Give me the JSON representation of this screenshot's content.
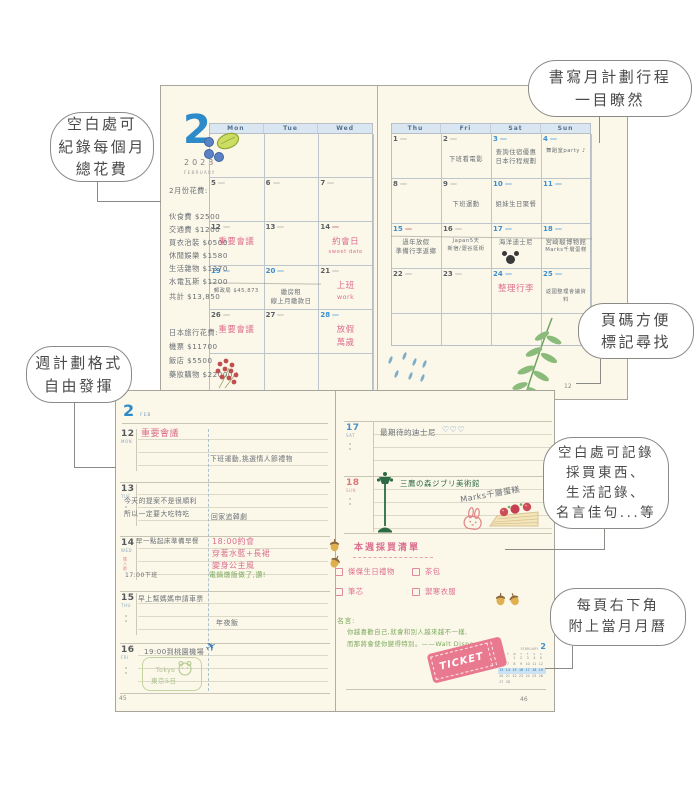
{
  "callouts": [
    {
      "id": "expense",
      "lines": [
        "空白處可",
        "紀錄每個月",
        "總花費"
      ]
    },
    {
      "id": "monthly-plan",
      "lines": [
        "書寫月計劃行程",
        "一目瞭然"
      ]
    },
    {
      "id": "page-number",
      "lines": [
        "頁碼方便",
        "標記尋找"
      ]
    },
    {
      "id": "weekly-format",
      "lines": [
        "週計劃格式",
        "自由發揮"
      ]
    },
    {
      "id": "blank-space",
      "lines": [
        "空白處可記錄",
        "採買東西、",
        "生活記錄、",
        "名言佳句...等"
      ]
    },
    {
      "id": "mini-calendar",
      "lines": [
        "每頁右下角",
        "附上當月月曆"
      ]
    }
  ],
  "monthly": {
    "month_number": "2",
    "year": "2023",
    "month_label": "FEBRUARY",
    "page_number": "12",
    "left_headers": [
      "Mon",
      "Tue",
      "Wed"
    ],
    "right_headers": [
      "Thu",
      "Fri",
      "Sat",
      "Sun"
    ],
    "expense_title": "2月份花費:",
    "expenses": [
      "伙食費 $2500",
      "交通費 $1200",
      "買衣治裝 $0500",
      "休閒娛樂 $1580",
      "生活雜物 $1370",
      "水電瓦斯 $1200"
    ],
    "expense_total": "共計 $13,850",
    "trip_title": "日本旅行花費:",
    "trip_expenses": [
      "機票 $11700",
      "飯店 $5500",
      "藥妝購物 $22000"
    ],
    "left_weeks": [
      [
        {
          "d": ""
        },
        {
          "d": ""
        },
        {
          "d": ""
        }
      ],
      [
        {
          "d": "5"
        },
        {
          "d": "6"
        },
        {
          "d": "7"
        }
      ],
      [
        {
          "d": "12",
          "notes": [
            {
              "t": "重要會議",
              "c": "pink",
              "big": true
            }
          ]
        },
        {
          "d": "13"
        },
        {
          "d": "14",
          "hl": "red",
          "notes": [
            {
              "t": "約會日",
              "c": "pink",
              "big": true
            },
            {
              "t": "sweet date",
              "c": "pink"
            }
          ]
        }
      ],
      [
        {
          "d": "19",
          "blue": true,
          "hl": "blue",
          "notes": [
            {
              "t": "郵政局 $45,873",
              "c": "ink"
            }
          ]
        },
        {
          "d": "20",
          "blue": true,
          "hl": "blue",
          "notes": [
            {
              "t": "繳房租",
              "c": "ink"
            },
            {
              "t": "線上月繳款日",
              "c": "ink"
            }
          ]
        },
        {
          "d": "21",
          "notes": [
            {
              "t": "上班",
              "c": "pink",
              "big": true
            },
            {
              "t": "work",
              "c": "pink"
            }
          ]
        }
      ],
      [
        {
          "d": "26",
          "notes": [
            {
              "t": "重要會議",
              "c": "pink",
              "big": true
            }
          ]
        },
        {
          "d": "27"
        },
        {
          "d": "28",
          "blue": true,
          "hl": "blue",
          "notes": [
            {
              "t": "放假",
              "c": "pink",
              "big": true
            },
            {
              "t": "萬歲",
              "c": "pink",
              "big": true
            }
          ]
        }
      ],
      [
        {
          "d": ""
        },
        {
          "d": ""
        },
        {
          "d": ""
        }
      ]
    ],
    "right_weeks": [
      [
        {
          "d": "1"
        },
        {
          "d": "2",
          "notes": [
            {
              "t": "下班看電影",
              "c": "ink"
            }
          ]
        },
        {
          "d": "3",
          "blue": true,
          "notes": [
            {
              "t": "查詢住宿優惠",
              "c": "ink"
            },
            {
              "t": "日本行程規劃",
              "c": "ink"
            }
          ]
        },
        {
          "d": "4",
          "blue": true,
          "notes": [
            {
              "t": "舞蹈室party ♪",
              "c": "ink"
            }
          ]
        }
      ],
      [
        {
          "d": "8"
        },
        {
          "d": "9",
          "notes": [
            {
              "t": "下班運動",
              "c": "ink"
            }
          ]
        },
        {
          "d": "10",
          "blue": true,
          "notes": [
            {
              "t": "姐妹生日聚餐",
              "c": "ink"
            }
          ]
        },
        {
          "d": "11",
          "blue": true
        }
      ],
      [
        {
          "d": "15",
          "blue": true,
          "hl": "red",
          "notes": [
            {
              "t": "過年放假",
              "c": "ink"
            },
            {
              "t": "準備行李返鄉",
              "c": "ink"
            }
          ]
        },
        {
          "d": "16",
          "notes": [
            {
              "t": "Japan5天",
              "c": "ink"
            },
            {
              "t": "新宿/澀谷逛街",
              "c": "ink"
            }
          ]
        },
        {
          "d": "17",
          "blue": true,
          "icon": "mickey",
          "notes": [
            {
              "t": "海洋迪士尼",
              "c": "ink"
            }
          ]
        },
        {
          "d": "18",
          "blue": true,
          "notes": [
            {
              "t": "宮崎駿博物館",
              "c": "ink"
            },
            {
              "t": "Marks千層蛋糕",
              "c": "ink"
            }
          ]
        }
      ],
      [
        {
          "d": "22"
        },
        {
          "d": "23"
        },
        {
          "d": "24",
          "blue": true,
          "notes": [
            {
              "t": "整理行李",
              "c": "pink",
              "big": true
            }
          ]
        },
        {
          "d": "25",
          "blue": true,
          "notes": [
            {
              "t": "返國整理會議資料",
              "c": "ink"
            }
          ]
        }
      ],
      [
        {
          "d": ""
        },
        {
          "d": ""
        },
        {
          "d": ""
        },
        {
          "d": ""
        }
      ]
    ]
  },
  "weekly": {
    "month_number": "2",
    "month_label": "FEB",
    "left_rows": [
      {
        "date": "12",
        "day": "MON",
        "notes": [
          {
            "t": "重要會議",
            "c": "pink"
          },
          {
            "t": "下班運動,挑選情人節禮物",
            "c": "ink"
          }
        ]
      },
      {
        "date": "13",
        "day": "TUE",
        "notes": [
          {
            "t": "今天的提案不是很順利",
            "c": "ink"
          },
          {
            "t": "所以一定要大吃特吃",
            "c": "ink"
          },
          {
            "t": "回家追韓劇",
            "c": "ink"
          }
        ]
      },
      {
        "date": "14",
        "day": "WED",
        "sub": "情人節",
        "notes": [
          {
            "t": "早一點起床準備早餐",
            "c": "ink"
          },
          {
            "t": "18:00約會",
            "c": "pink"
          },
          {
            "t": "穿著水藍+長裙",
            "c": "pink"
          },
          {
            "t": "變身公主風",
            "c": "pink"
          },
          {
            "t": "17:00下班",
            "c": "ink"
          },
          {
            "t": "電鍋燉飯做了,讚!",
            "c": "green"
          }
        ]
      },
      {
        "date": "15",
        "day": "THU",
        "notes": [
          {
            "t": "早上幫媽媽申請車票",
            "c": "ink"
          },
          {
            "t": "年夜飯",
            "c": "ink"
          }
        ]
      },
      {
        "date": "16",
        "day": "FRI",
        "notes": [
          {
            "t": "19:00到桃園機場",
            "c": "ink"
          },
          {
            "t": "Tokyo",
            "c": "lgreen"
          },
          {
            "t": "東京5日",
            "c": "lgreen"
          }
        ]
      }
    ],
    "right_rows": [
      {
        "date": "17",
        "day": "SAT",
        "notes": [
          {
            "t": "最期待的迪士尼",
            "c": "ink"
          },
          {
            "t": "♡♡♡",
            "c": "blue"
          }
        ]
      },
      {
        "date": "18",
        "day": "SUN",
        "notes": [
          {
            "t": "三鷹の森ジブリ美術館",
            "c": "dgreen"
          },
          {
            "t": "Marks千層蛋糕",
            "c": "ink"
          }
        ]
      }
    ],
    "shopping": {
      "title": "本週採買清單",
      "items": [
        "傑傑生日禮物",
        "茶包",
        "筆芯",
        "禦寒衣服"
      ]
    },
    "quote_label": "名言:",
    "quote_lines": [
      "你越喜歡自己,就會和別人越來越不一樣,",
      "而那將會使你變得特別。——Walt Disney"
    ],
    "ticket_label": "TICKET",
    "mini_calendar": {
      "title": "FEBRUARY",
      "month_number": "2",
      "weekdays": [
        "M",
        "T",
        "W",
        "T",
        "F",
        "S",
        "S"
      ],
      "weeks": [
        [
          "",
          "",
          "1",
          "2",
          "3",
          "4",
          "5"
        ],
        [
          "6",
          "7",
          "8",
          "9",
          "10",
          "11",
          "12"
        ],
        [
          "13",
          "14",
          "15",
          "16",
          "17",
          "18",
          "19"
        ],
        [
          "20",
          "21",
          "22",
          "23",
          "24",
          "25",
          "26"
        ],
        [
          "27",
          "28",
          "",
          "",
          "",
          "",
          ""
        ]
      ],
      "highlight_week_index": 2
    },
    "left_page_number": "45",
    "right_page_number": "46"
  },
  "icons": {
    "plane_icon": "✈",
    "hearts": "♡♡♡",
    "music_note": "♪"
  },
  "doodles": [
    "blueberries-and-lime",
    "red-flower-cluster",
    "raindrops",
    "fern-leaf",
    "mickey-head",
    "street-lamp",
    "bunny-stamp",
    "strawberry-crepe-cake",
    "acorns",
    "frog",
    "airplane",
    "ticket-stamp"
  ],
  "colors": {
    "page_bg": "#FBF8EA",
    "accent_blue": "#2E8BC9",
    "pink": "#DC6E8F",
    "green": "#7CA85C",
    "dark_green": "#2F6B45",
    "light_green": "#A9BE88",
    "ink": "#6B6F75",
    "ticket_pink": "#E8798F",
    "header_band": "#DAE7F2"
  }
}
